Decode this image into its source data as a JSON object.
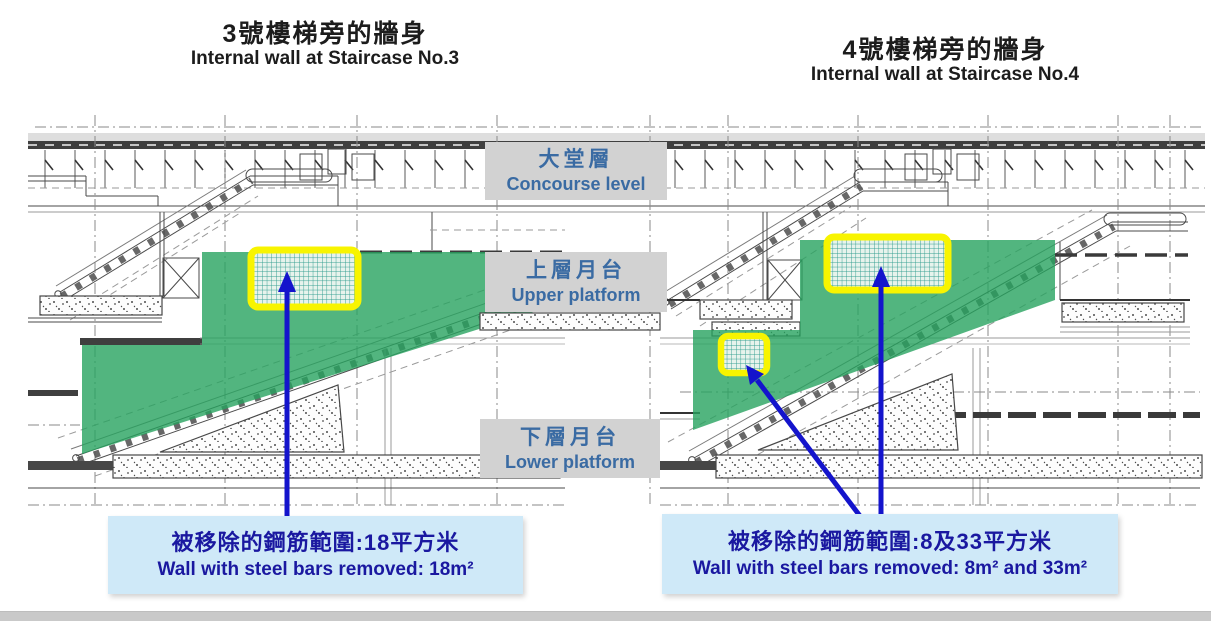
{
  "titles": {
    "left": {
      "zh": "3號樓梯旁的牆身",
      "en": "Internal wall at Staircase No.3"
    },
    "right": {
      "zh": "4號樓梯旁的牆身",
      "en": "Internal wall at Staircase No.4"
    }
  },
  "level_labels": [
    {
      "zh": "大堂層",
      "en": "Concourse level"
    },
    {
      "zh": "上層月台",
      "en": "Upper platform"
    },
    {
      "zh": "下層月台",
      "en": "Lower platform"
    }
  ],
  "notes": {
    "left": {
      "zh": "被移除的鋼筋範圍:18平方米",
      "en": "Wall with steel bars removed: 18m²"
    },
    "right": {
      "zh": "被移除的鋼筋範圍:8及33平方米",
      "en": "Wall with steel bars removed: 8m² and 33m²"
    }
  },
  "highlight_areas": {
    "left_m2": "18",
    "right_m2": "8 and 33"
  },
  "colors": {
    "green-overlay": "#27a35f",
    "highlight-yellow": "#f8f400",
    "grid-line": "#2f9c8e",
    "grid-bg": "#e7f3ec",
    "arrow-blue": "#1414cc",
    "level-box-bg": "#d2d2d2",
    "level-text": "#3a6ba3",
    "note-bg": "#cfe9f8",
    "note-text": "#1a18a0",
    "title-text": "#1c1c1c",
    "bottom-bar": "#c9c9c9"
  }
}
